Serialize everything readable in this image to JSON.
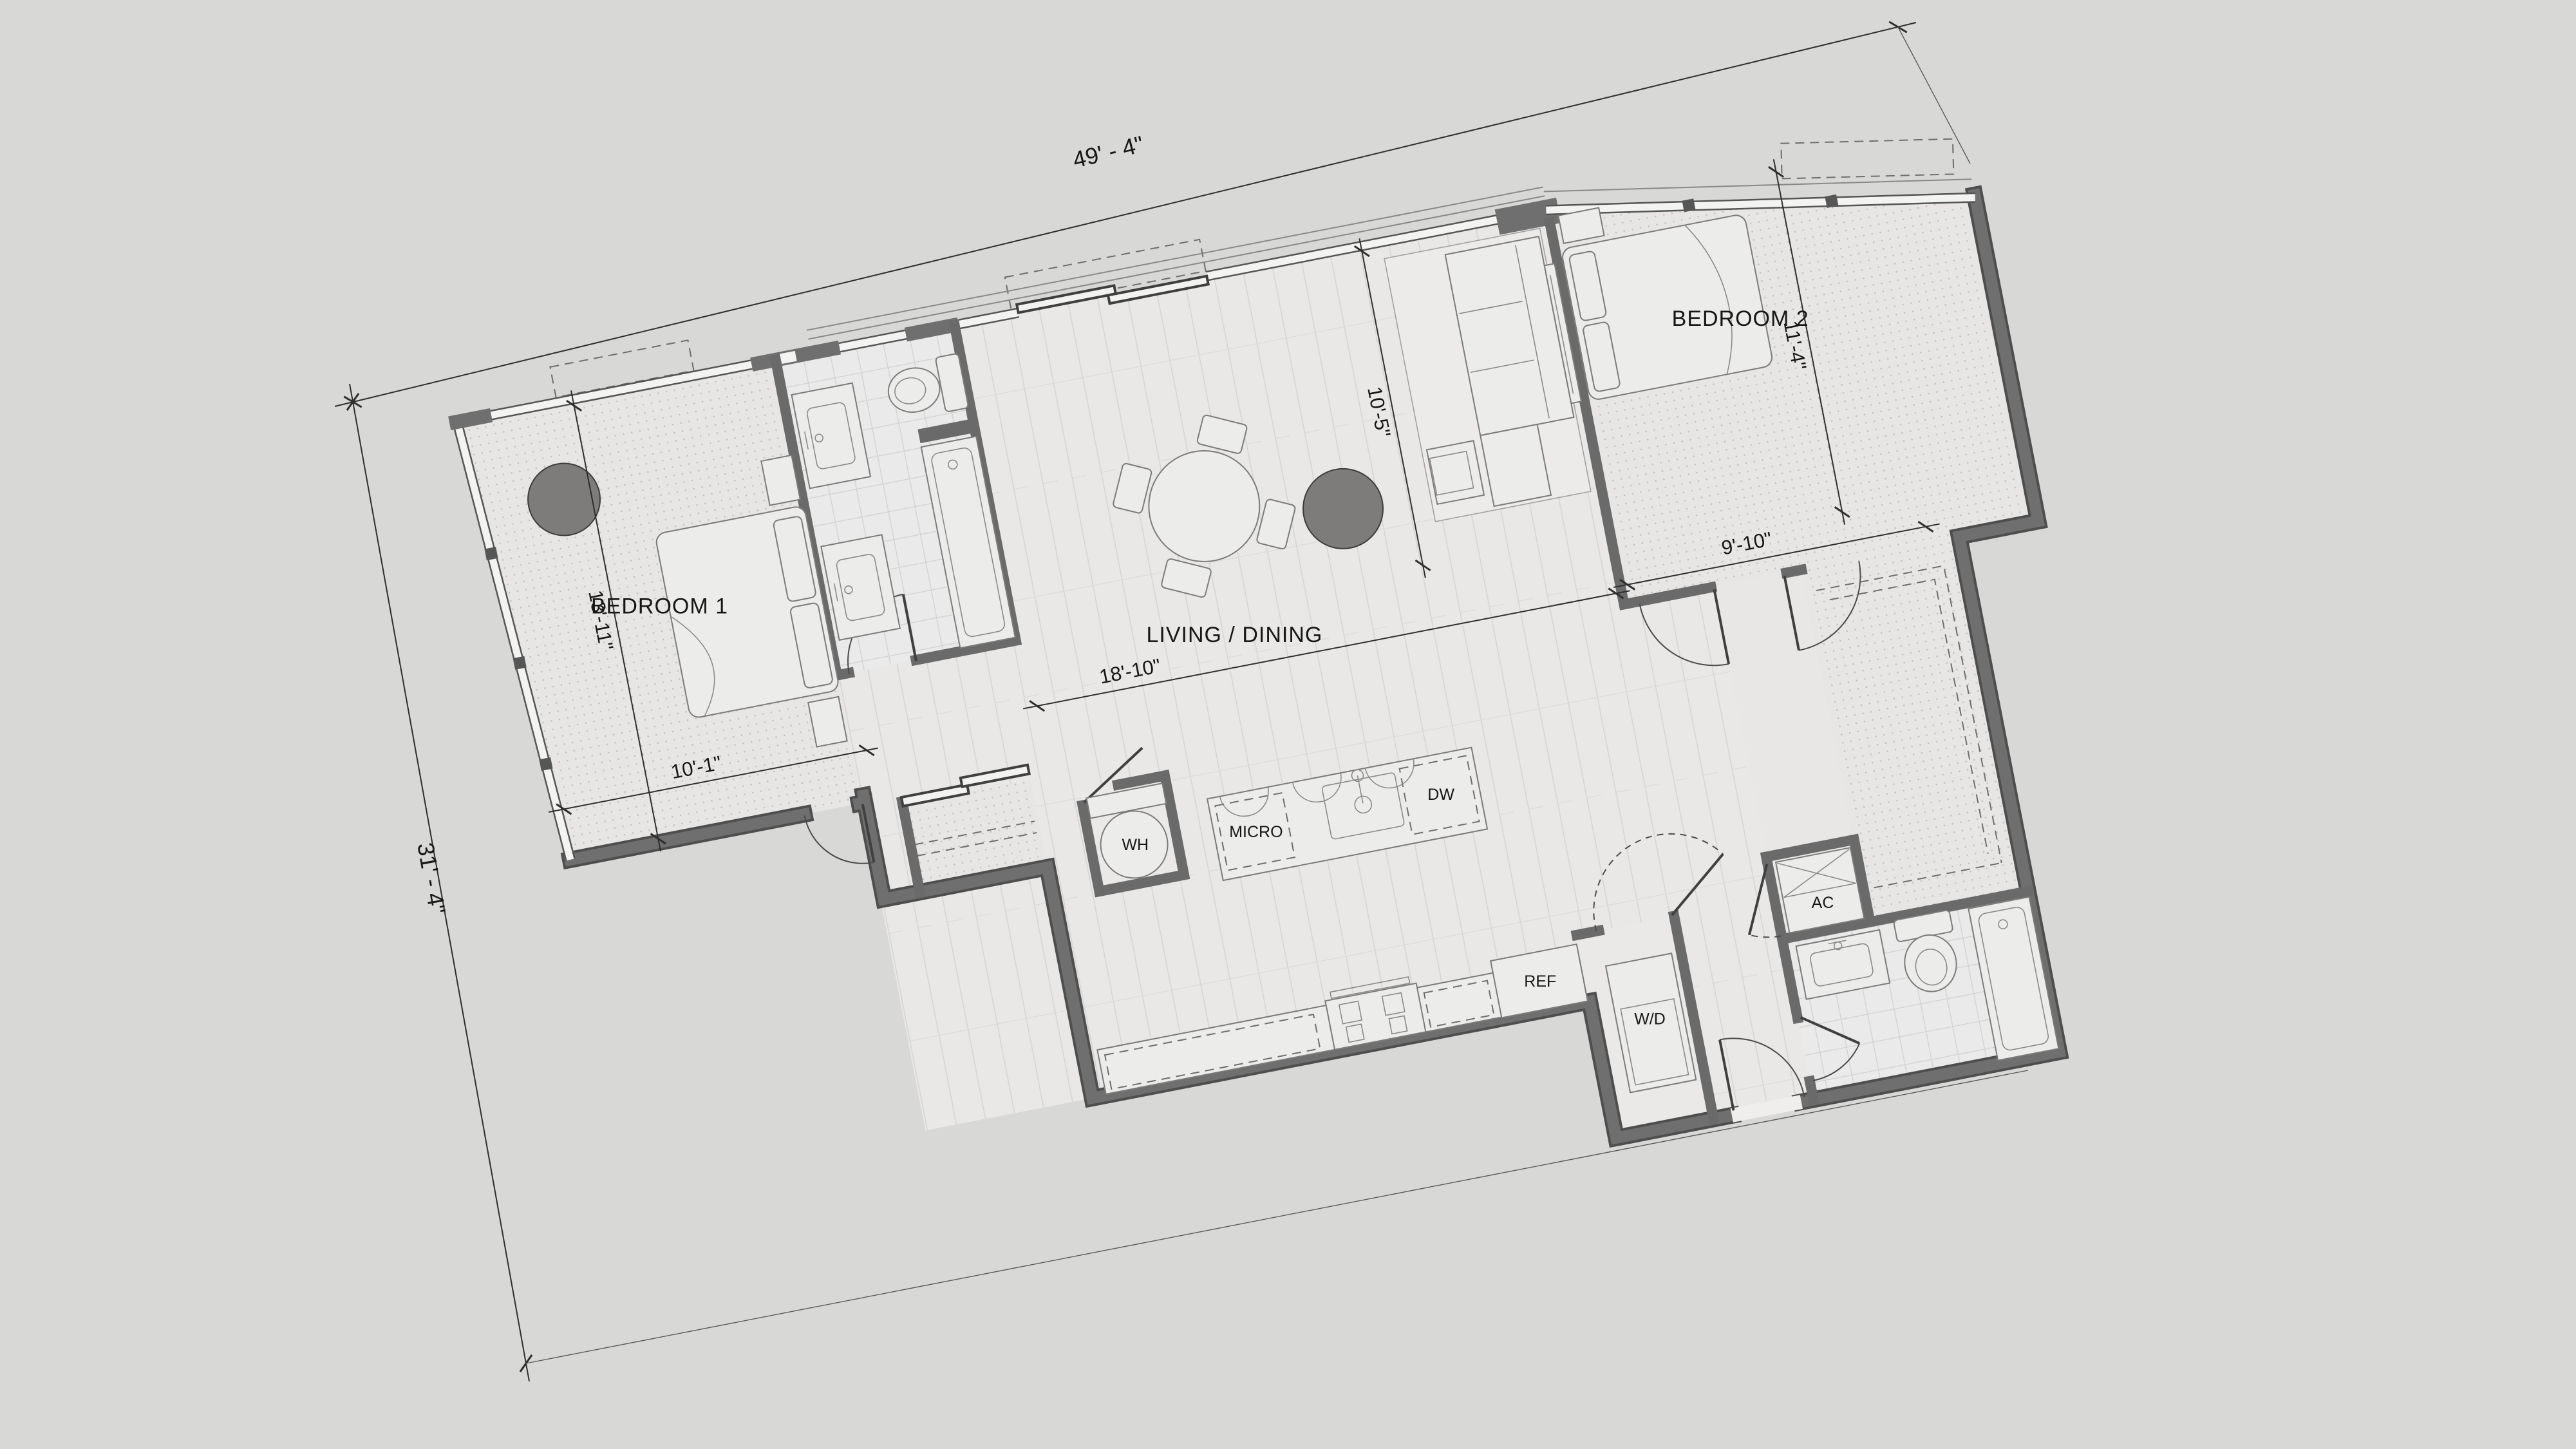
{
  "plan": {
    "type": "apartment-floor-plan",
    "overall": {
      "width_label": "49' - 4\"",
      "height_label": "31' - 4\""
    },
    "rooms": {
      "bedroom1": {
        "label": "BEDROOM 1",
        "depth": "13'-11\"",
        "width": "10'-1\""
      },
      "living": {
        "label": "LIVING / DINING",
        "width": "18'-10\"",
        "depth": "10'-5\""
      },
      "bedroom2": {
        "label": "BEDROOM 2",
        "depth": "11'-4\"",
        "width": "9'-10\""
      }
    },
    "appliances": {
      "water_heater": "WH",
      "microwave": "MICRO",
      "dishwasher": "DW",
      "refrigerator": "REF",
      "washer_dryer": "W/D",
      "air_conditioner": "AC"
    },
    "colors": {
      "background": "#d8d8d7",
      "walls": "#6f6f6f",
      "wall_edge": "#4e4e4e",
      "carpet": "#e7e6e5",
      "planks": "#e9e8e7",
      "tile": "#ebeaea",
      "column": "#7d7c7b",
      "text": "#161616"
    },
    "rotation_deg": -11
  }
}
